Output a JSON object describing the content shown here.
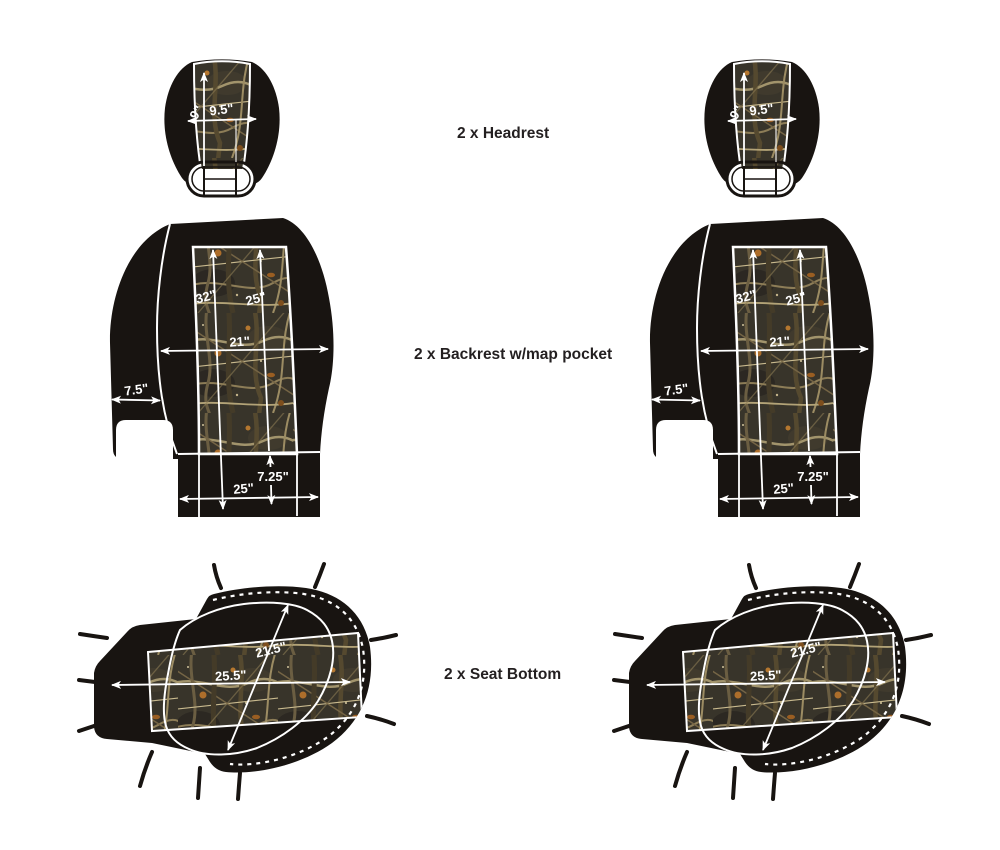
{
  "rows": {
    "headrest": {
      "label": "2 x Headrest",
      "dims": {
        "panel_height": "9\"",
        "panel_width": "9.5\""
      }
    },
    "backrest": {
      "label": "2 x Backrest w/map pocket",
      "dims": {
        "overall_height": "32\"",
        "panel_height": "25\"",
        "body_width": "21\"",
        "side_width": "7.5\"",
        "pocket_drop": "7.25\"",
        "pocket_width": "25\""
      }
    },
    "seat": {
      "label": "2 x Seat Bottom",
      "dims": {
        "depth": "21.5\"",
        "width": "25.5\""
      }
    }
  },
  "quantity_per_piece": 2,
  "colors": {
    "background": "#ffffff",
    "fabric_black": "#181411",
    "camo_base": "#38342a",
    "dimension_line": "#ffffff",
    "caption_text": "#231f20"
  }
}
